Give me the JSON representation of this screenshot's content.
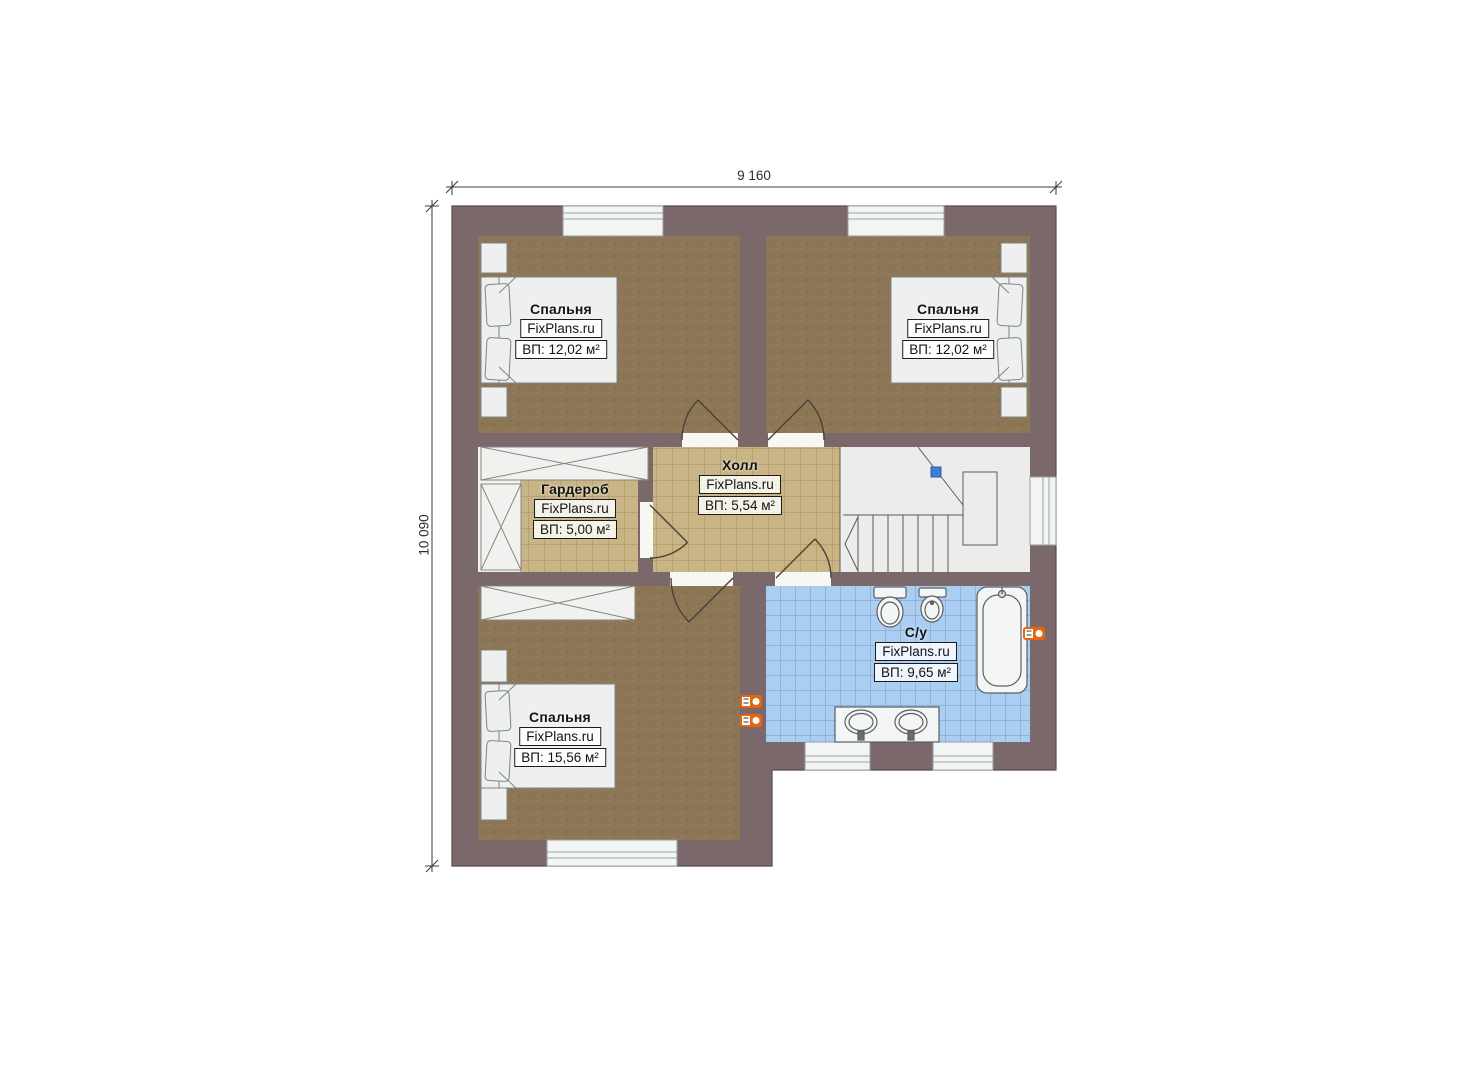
{
  "plan": {
    "watermark": "FixPlans.ru",
    "dimensions": {
      "width": "9 160",
      "height": "10 090"
    },
    "rooms": [
      {
        "id": "bedroom-top-left",
        "name": "Спальня",
        "area": "ВП: 12,02 м²"
      },
      {
        "id": "bedroom-top-right",
        "name": "Спальня",
        "area": "ВП: 12,02 м²"
      },
      {
        "id": "wardrobe",
        "name": "Гардероб",
        "area": "ВП: 5,00 м²"
      },
      {
        "id": "hall",
        "name": "Холл",
        "area": "ВП: 5,54 м²"
      },
      {
        "id": "bathroom",
        "name": "С/у",
        "area": "ВП: 9,65 м²"
      },
      {
        "id": "bedroom-bottom",
        "name": "Спальня",
        "area": "ВП: 15,56 м²"
      }
    ],
    "colors": {
      "wall": "#7b686b",
      "floor_wood": "#8c7656",
      "floor_tile_tan": "#c8b484",
      "floor_tile_blue": "#aacdf2",
      "furniture": "#eef0ef",
      "marker_orange": "#e8650f",
      "stair_marker_blue": "#3d7edb"
    }
  }
}
